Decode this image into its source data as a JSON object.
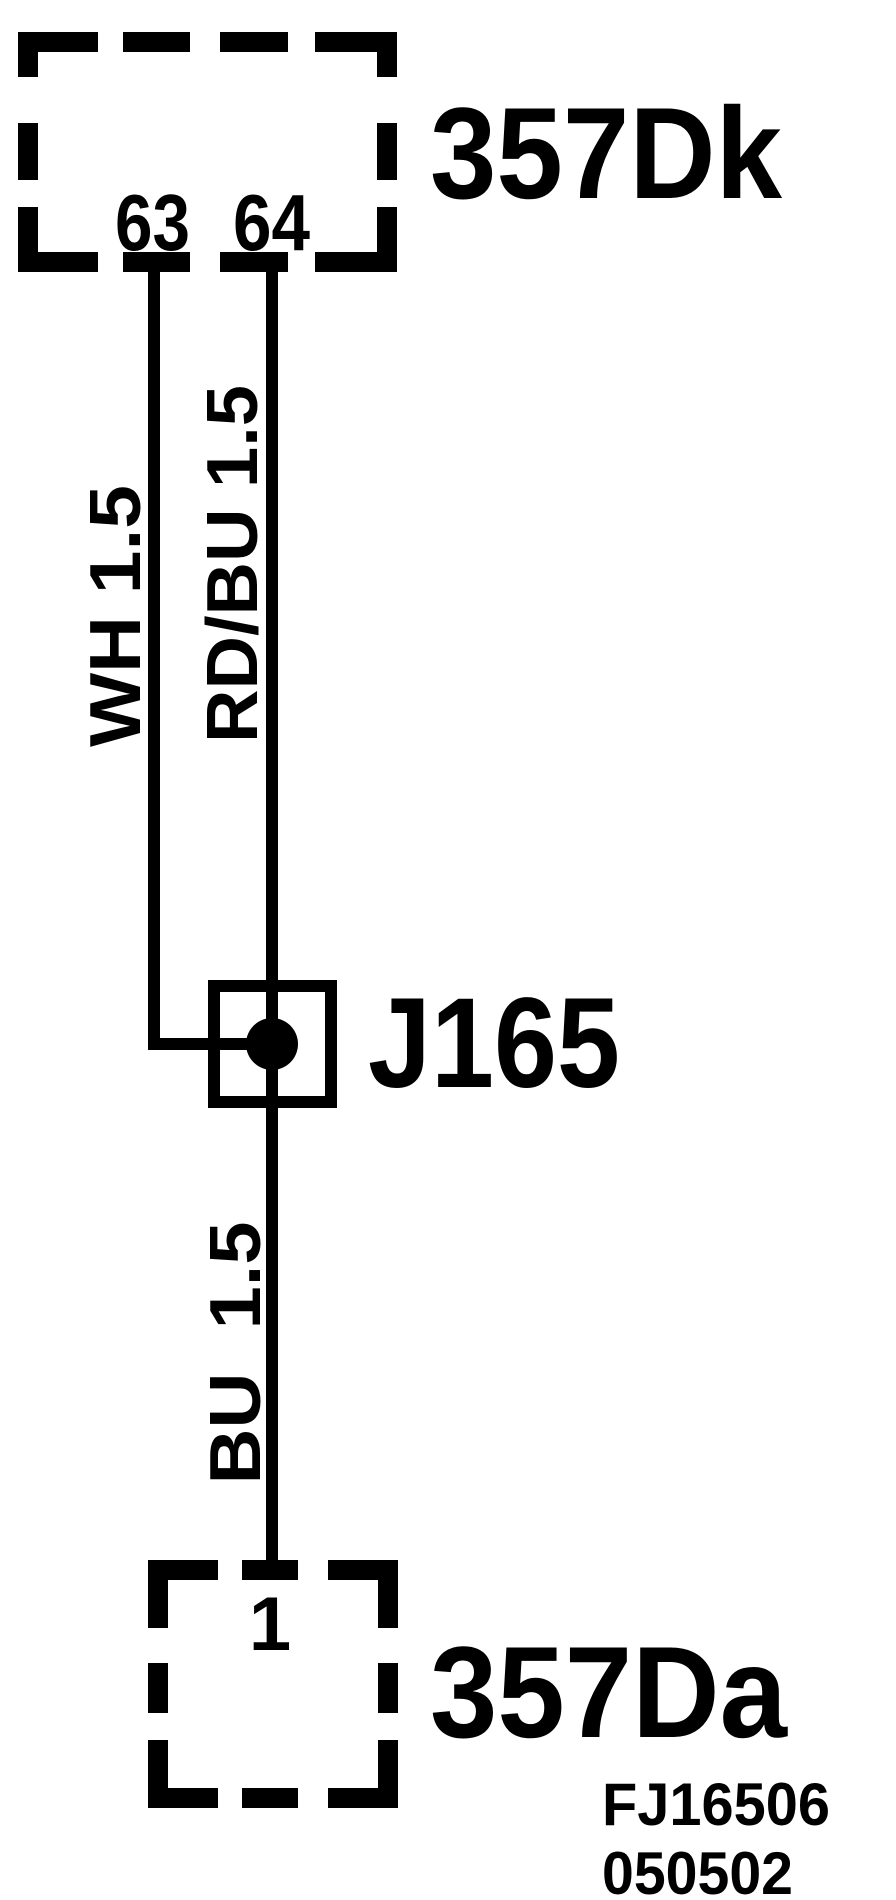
{
  "page": {
    "background": "#ffffff",
    "ink": "#000000",
    "type": "wiring-diagram"
  },
  "top_connector": {
    "label": "357Dk",
    "pin_left": "63",
    "pin_right": "64"
  },
  "junction": {
    "label": "J165"
  },
  "bottom_connector": {
    "label": "357Da",
    "pin": "1"
  },
  "wires": {
    "left": {
      "label": "WH 1.5"
    },
    "right": {
      "label": "RD/BU 1.5"
    },
    "lower": {
      "label": "BU  1.5"
    }
  },
  "footer": {
    "line1": "FJ16506",
    "line2": "050502"
  }
}
